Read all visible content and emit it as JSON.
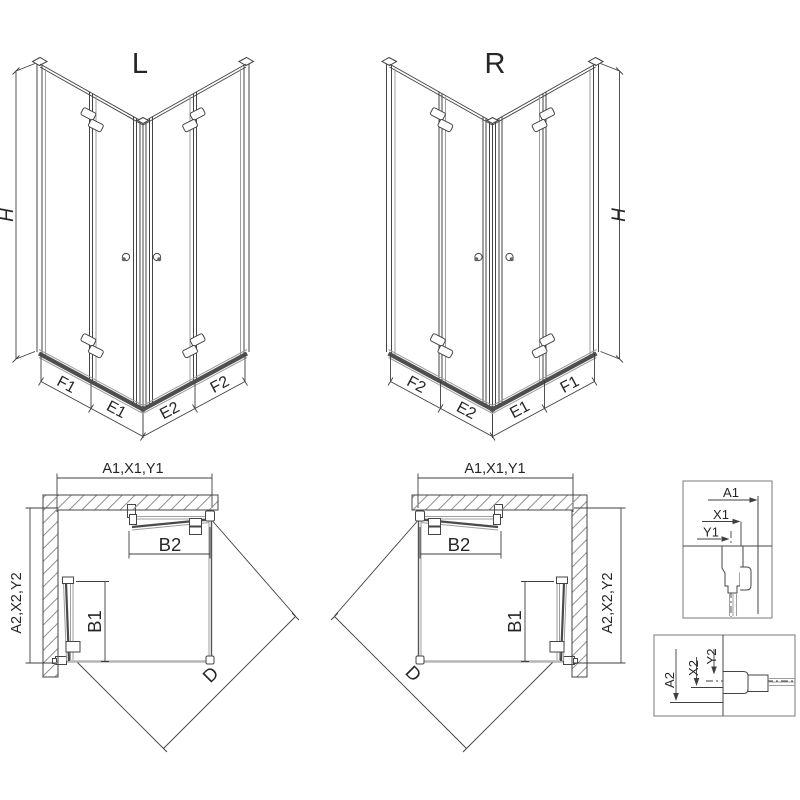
{
  "drawing": {
    "iso_left": {
      "title": "L",
      "height_label": "H",
      "seg_labels": [
        "F1",
        "E1",
        "E2",
        "F2"
      ]
    },
    "iso_right": {
      "title": "R",
      "height_label": "H",
      "seg_labels": [
        "F2",
        "E2",
        "E1",
        "F1"
      ]
    },
    "plan_left": {
      "width_label": "A1,X1,Y1",
      "side_label": "A2,X2,Y2",
      "b1": "B1",
      "b2": "B2",
      "diag": "D"
    },
    "plan_right": {
      "width_label": "A1,X1,Y1",
      "side_label": "A2,X2,Y2",
      "b1": "B1",
      "b2": "B2",
      "diag": "D"
    },
    "detail_top": {
      "a": "A1",
      "x": "X1",
      "y": "Y1"
    },
    "detail_bottom": {
      "a": "A2",
      "x": "X2",
      "y": "Y2"
    },
    "colors": {
      "line": "#454545",
      "glass": "#9e9e9e",
      "rail": "#4f4f4f",
      "hatch": "#8f8f8f",
      "tray": "#b5b5b5",
      "text": "#262626",
      "background": "#ffffff"
    }
  }
}
